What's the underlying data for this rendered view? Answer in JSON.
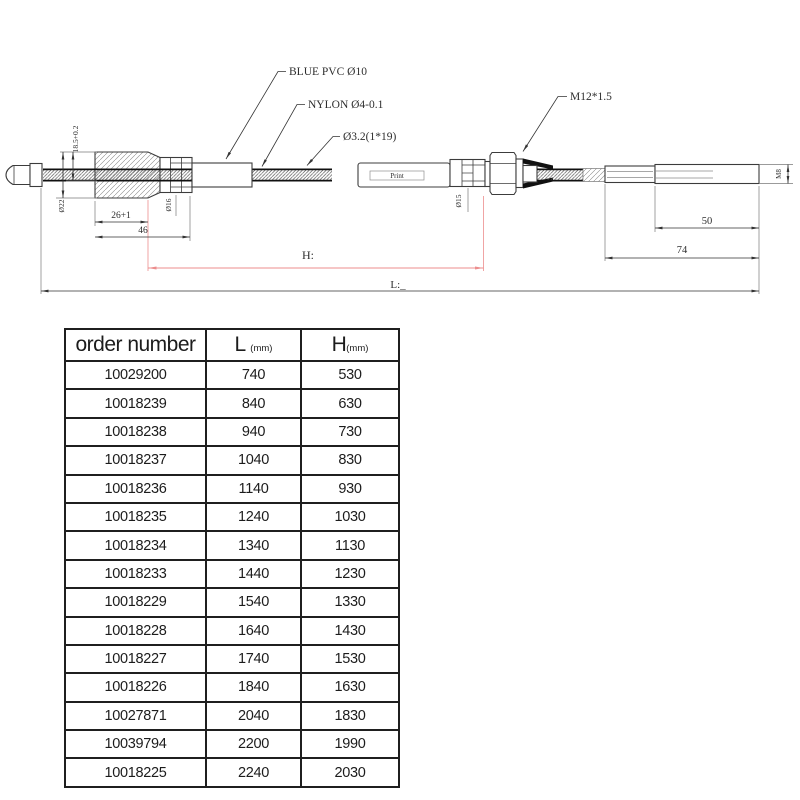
{
  "drawing": {
    "callouts": {
      "blue_pvc": "BLUE PVC Ø10",
      "nylon": "NYLON Ø4-0.1",
      "cable_strand": "Ø3.2(1*19)",
      "thread": "M12*1.5"
    },
    "dims": {
      "housing_od": "Ø22",
      "housing_h": "18.5+0.2",
      "connector_od": "Ø16",
      "sleeve_od": "Ø15",
      "len_26": "26+1",
      "len_46": "46",
      "len_50": "50",
      "len_74": "74",
      "rod_thread": "M8",
      "h_label": "H:",
      "l_label": "L:_"
    },
    "print_label": "Print",
    "colors": {
      "line": "#3c3c3c",
      "accent_red": "#ec8d8d"
    }
  },
  "table": {
    "headers": {
      "col0": "order number",
      "col1": "L",
      "col1_unit": "(mm)",
      "col2": "H",
      "col2_unit": "(mm)"
    },
    "rows": [
      [
        "10029200",
        "740",
        "530"
      ],
      [
        "10018239",
        "840",
        "630"
      ],
      [
        "10018238",
        "940",
        "730"
      ],
      [
        "10018237",
        "1040",
        "830"
      ],
      [
        "10018236",
        "1140",
        "930"
      ],
      [
        "10018235",
        "1240",
        "1030"
      ],
      [
        "10018234",
        "1340",
        "1130"
      ],
      [
        "10018233",
        "1440",
        "1230"
      ],
      [
        "10018229",
        "1540",
        "1330"
      ],
      [
        "10018228",
        "1640",
        "1430"
      ],
      [
        "10018227",
        "1740",
        "1530"
      ],
      [
        "10018226",
        "1840",
        "1630"
      ],
      [
        "10027871",
        "2040",
        "1830"
      ],
      [
        "10039794",
        "2200",
        "1990"
      ],
      [
        "10018225",
        "2240",
        "2030"
      ]
    ]
  }
}
